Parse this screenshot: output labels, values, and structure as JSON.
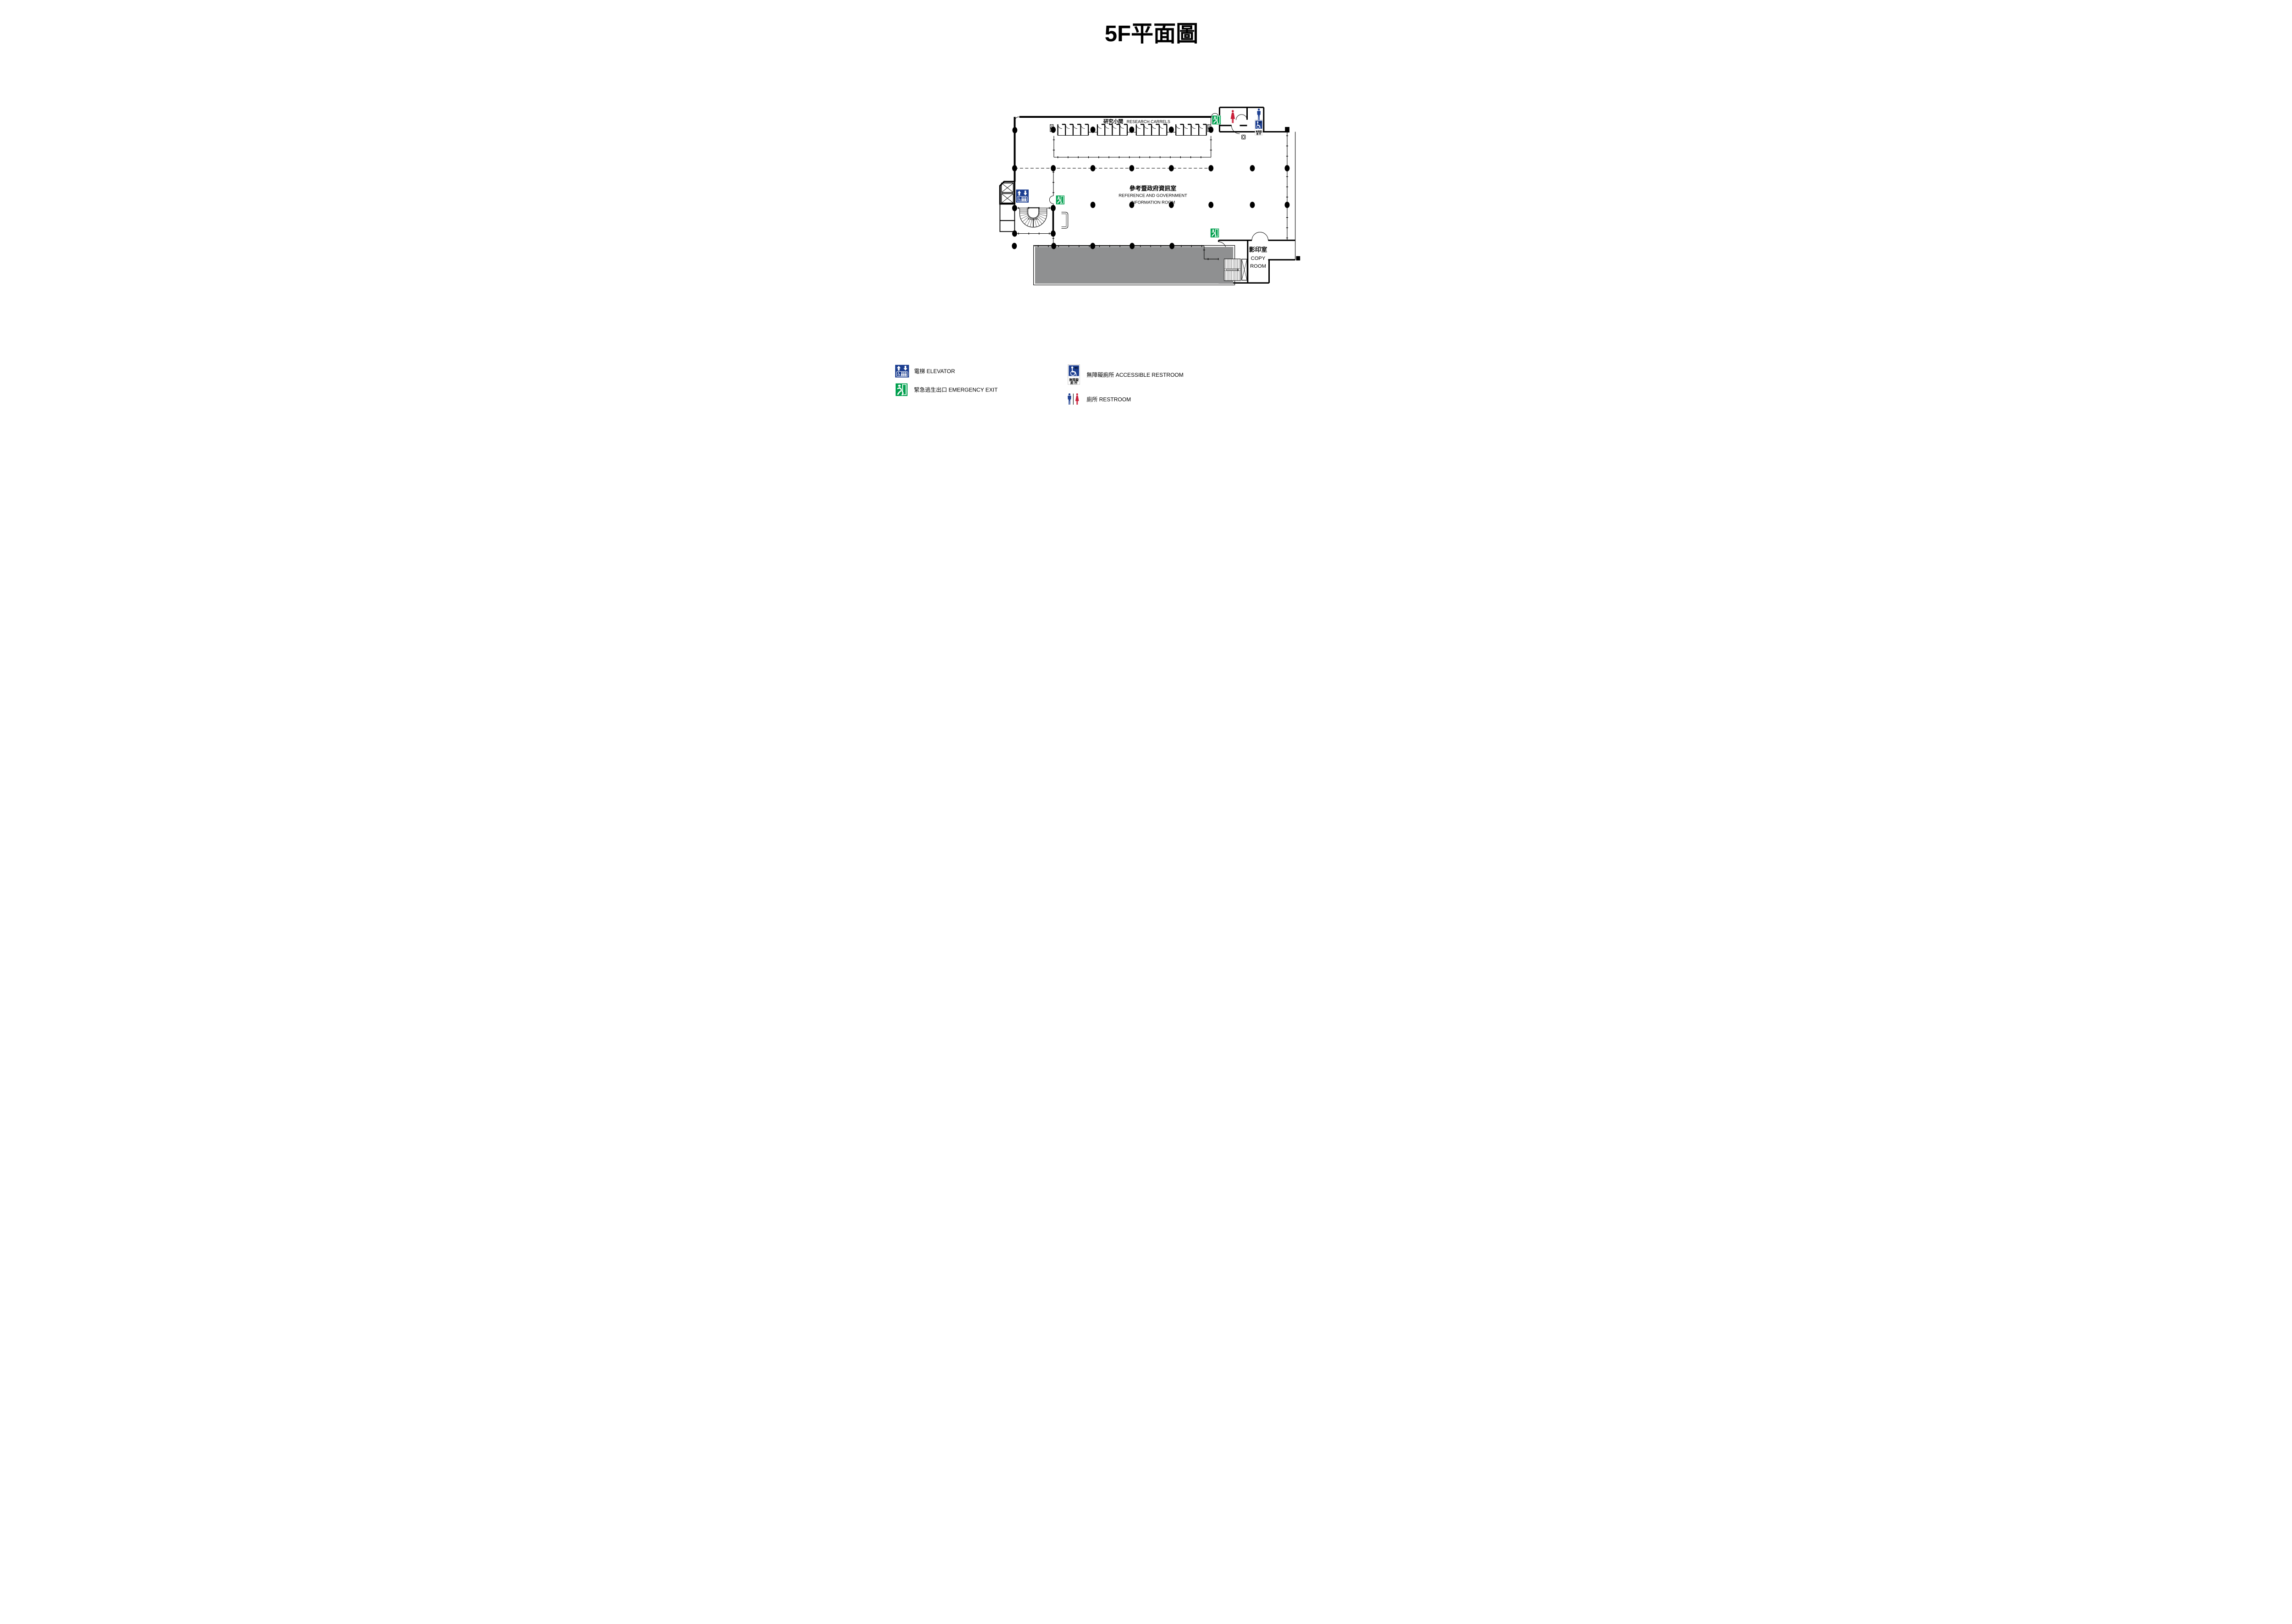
{
  "title": "5F平面圖",
  "plan": {
    "research_carrels": {
      "zh": "研究小間",
      "en": "RESEARCH CARRELS"
    },
    "reference_room": {
      "zh": "參考暨政府資訊室",
      "en_line1": "REFERENCE AND GOVERNMENT",
      "en_line2": "INFORMATION ROOM"
    },
    "copy_room": {
      "zh": "影印室",
      "en_line1": "COPY",
      "en_line2": "ROOM"
    }
  },
  "signs": {
    "accessible_restroom": {
      "wc": "WC",
      "zh_line1": "無障礙",
      "zh_line2": "廁 所"
    }
  },
  "legend": {
    "items": [
      {
        "icon": "elevator-sign-icon",
        "label": "電梯 ELEVATOR"
      },
      {
        "icon": "emergency-exit-icon",
        "label": "緊急逃生出口 EMERGENCY EXIT"
      },
      {
        "icon": "accessible-restroom-icon",
        "label": "無障礙廁所 ACCESSIBLE RESTROOM"
      },
      {
        "icon": "restroom-icon",
        "label": "廁所 RESTROOM"
      }
    ]
  },
  "colors": {
    "exit_green": "#00A04E",
    "sign_blue": "#1D3F91",
    "female_red": "#C9203A",
    "terrace_gray": "#8F9091",
    "wall": "#000000"
  }
}
